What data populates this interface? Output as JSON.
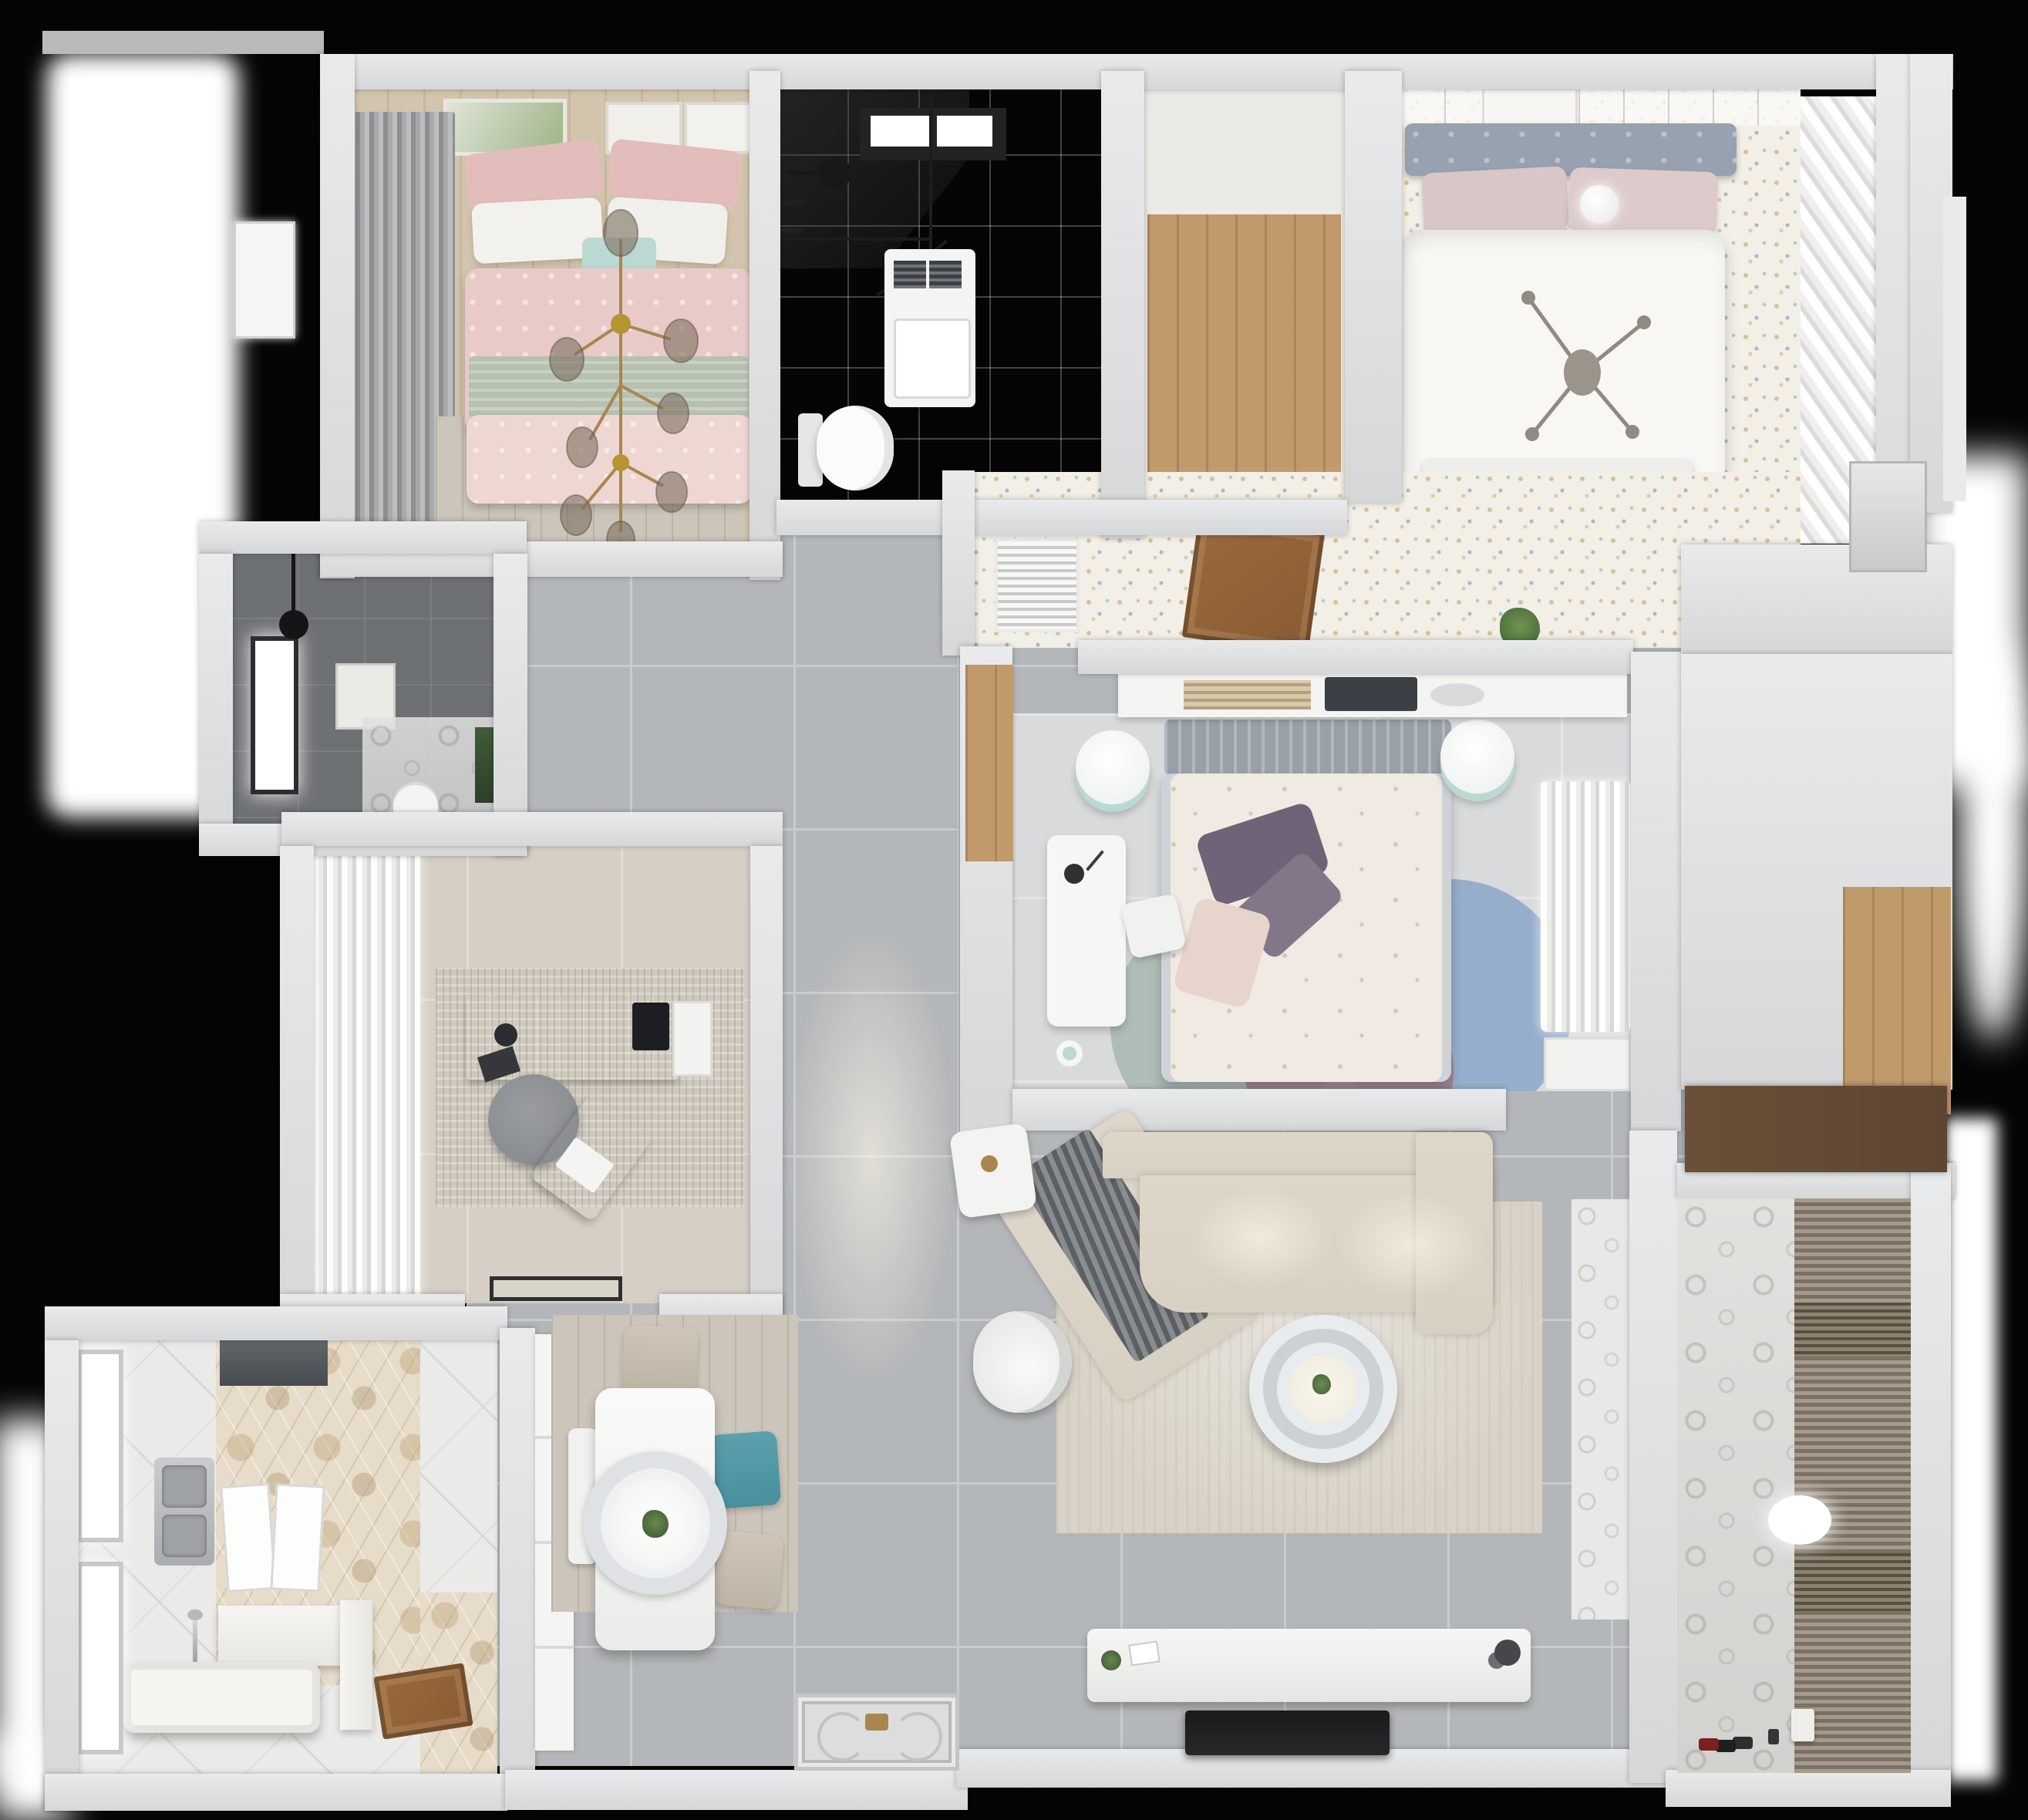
{
  "scene": {
    "title": "Apartment 3D floor plan — top-down render",
    "view": "bird's-eye dollhouse render, no visible text labels"
  },
  "colors": {
    "background": "#050505",
    "wall": "#d6d7d9",
    "wall_light": "#e9eaec",
    "tile_gray": "#b4b7b9",
    "tile_pale": "#d8dadc",
    "tile_beige": "#d6cfc5",
    "tile_white": "#eaeae8",
    "tile_dark": "#6e7174",
    "wood_light": "#d3c5ad",
    "wood_mid": "#c19a6b",
    "wood_rug": "#ccc5ba",
    "floral_base": "#f2efe7",
    "hex_base": "#e6dcc9",
    "pink_duvet": "#e8cbc8",
    "pink_pillow": "#e3bdbb",
    "sage_throw": "#b7c1b1",
    "mint": "#bcd8d2",
    "headboard_blue": "#97a1af",
    "teal_chair": "#47909f",
    "purple_pillow": "#6f6377",
    "blush": "#e7d5cd",
    "rug_blue": "#8fa8c9",
    "rug_mauve": "#a28691",
    "rug_sage": "#a9b8b3",
    "sofa": "#d8d1c3",
    "rug_living": "#d9d3c7",
    "door_brown": "#8a5a33",
    "cabinet_brown": "#5e4632",
    "gold": "#a8874f",
    "plant_green": "#5c7d4a"
  },
  "rooms": [
    {
      "id": "bedroom-pink",
      "label": "Bedroom with pink double bed",
      "furniture": [
        "double bed",
        "pink patterned duvet",
        "sage green throw",
        "pink pillows",
        "white pillows",
        "mint accent pillow",
        "gold branch chandelier",
        "dark gray curtains",
        "three wall art frames",
        "tan floor rug",
        "wood floor"
      ]
    },
    {
      "id": "bathroom-top",
      "label": "Bathroom with walk-in shower",
      "furniture": [
        "black framed glass shower",
        "rain shower head",
        "skylight window",
        "washing machine",
        "wall-hung toilet",
        "gray marble tile floor"
      ]
    },
    {
      "id": "utility-closet",
      "label": "Walk-in closet / utility room",
      "furniture": [
        "wood plank floor"
      ]
    },
    {
      "id": "bedroom-blue",
      "label": "Bedroom with white double bed",
      "furniture": [
        "double bed",
        "blue-gray tufted headboard",
        "pink pillows",
        "white duvet",
        "sphere lamp",
        "cross ceiling light",
        "art print",
        "slatted sliding wardrobe",
        "terrazzo floral floor",
        "bed-end bench"
      ]
    },
    {
      "id": "corridor-floral",
      "label": "Dressing corridor",
      "furniture": [
        "air-conditioner vent",
        "open wooden door",
        "plant on half wall",
        "terrazzo floral floor"
      ]
    },
    {
      "id": "bedroom-center",
      "label": "Center bedroom",
      "furniture": [
        "double bed",
        "gray headboard",
        "floral cream duvet",
        "purple pillows",
        "blush pillow",
        "headboard shelf with books and tablet",
        "two teal drum stools",
        "white desk",
        "desk chair",
        "round rugs blue mauve sage",
        "sheer curtains",
        "white wardrobe",
        "mint cup"
      ]
    },
    {
      "id": "bathroom-dark",
      "label": "Dark tiled bathroom",
      "furniture": [
        "black rain shower",
        "bright window",
        "toilet",
        "art frame",
        "green plant"
      ]
    },
    {
      "id": "study",
      "label": "Study",
      "furniture": [
        "wood desk",
        "monitor",
        "white board",
        "desk accessories",
        "gray round chair",
        "tan lounge chair with laptop",
        "white sheer curtains",
        "mottled rug",
        "door mat"
      ]
    },
    {
      "id": "bathroom-tub",
      "label": "Bathroom with freestanding tub",
      "furniture": [
        "freestanding bathtub",
        "chrome floor tub filler",
        "stainless double sink",
        "white vanity counter",
        "two mirror panels",
        "dark hood cabinet",
        "hexagon tile wall",
        "two windows",
        "open wooden door"
      ]
    },
    {
      "id": "dining",
      "label": "Dining area",
      "furniture": [
        "white dining table",
        "ring pendant lamp",
        "plant centerpiece",
        "two beige chairs",
        "teal chair",
        "white bench",
        "wood plank rug",
        "tall white cabinet"
      ]
    },
    {
      "id": "living",
      "label": "Living room",
      "furniture": [
        "L-shaped beige sectional sofa",
        "gray throw blanket",
        "round two-tier coffee table",
        "white armchair",
        "white side table",
        "TV console with decor",
        "flat TV on wall",
        "beige area rug",
        "gray tile floor"
      ]
    },
    {
      "id": "balcony",
      "label": "Balcony / laundry room",
      "furniture": [
        "patterned tile wall",
        "brown roller blinds",
        "oval ceiling light",
        "toys on floor",
        "small white can"
      ]
    },
    {
      "id": "hallway",
      "label": "Hallway",
      "furniture": [
        "ornate entrance mat",
        "gray tile floor",
        "wood threshold strip"
      ]
    },
    {
      "id": "right-corridor",
      "label": "Right corridor and closet",
      "furniture": [
        "wood floor niche",
        "dark brown cabinet",
        "gray door panel",
        "white exterior door"
      ]
    }
  ]
}
